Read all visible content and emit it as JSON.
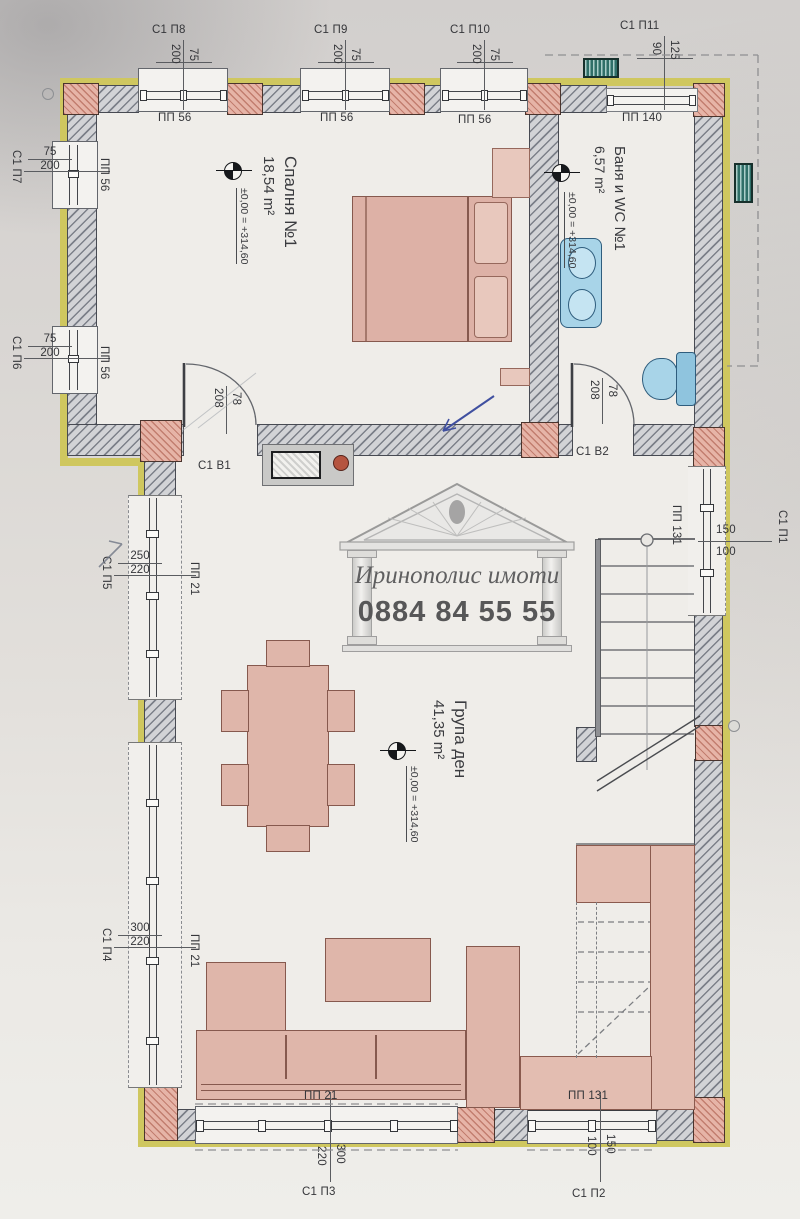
{
  "watermark": {
    "agency": "Иринополис имоти",
    "phone": "0884 84 55 55"
  },
  "rooms": {
    "bedroom": {
      "name": "Спалня №1",
      "area": "18,54 m²",
      "level": "±0,00 = +314,60"
    },
    "bath": {
      "name": "Баня и WC №1",
      "area": "6,57 m²",
      "level": "±0,00 = +314,60"
    },
    "living": {
      "name": "Група ден",
      "area": "41,35 m²",
      "level": "±0,00 = +314,60"
    }
  },
  "windows": {
    "p8": {
      "code": "С1 П8",
      "dim_a": "200",
      "dim_b": "75",
      "lintel": "ПП 56"
    },
    "p9": {
      "code": "С1 П9",
      "dim_a": "200",
      "dim_b": "75",
      "lintel": "ПП 56"
    },
    "p10": {
      "code": "С1 П10",
      "dim_a": "200",
      "dim_b": "75",
      "lintel": "ПП 56"
    },
    "p11": {
      "code": "С1 П11",
      "dim_a": "90",
      "dim_b": "125",
      "lintel": "ПП 140"
    },
    "p7": {
      "code": "С1 П7",
      "dim_a": "75",
      "dim_b": "200",
      "lintel": "ПП 56"
    },
    "p6": {
      "code": "С1 П6",
      "dim_a": "75",
      "dim_b": "200",
      "lintel": "ПП 56"
    },
    "p5": {
      "code": "С1 П5",
      "dim_a": "250",
      "dim_b": "220",
      "lintel": "ПП 21"
    },
    "p4": {
      "code": "С1 П4",
      "dim_a": "300",
      "dim_b": "220",
      "lintel": "ПП 21"
    },
    "p1": {
      "code": "С1 П1",
      "dim_a": "150",
      "dim_b": "100",
      "lintel": "ПП 131"
    },
    "p3": {
      "code": "С1 П3",
      "dim_a": "220",
      "dim_b": "300",
      "lintel": "ПП 21"
    },
    "p2": {
      "code": "С1 П2",
      "dim_a": "100",
      "dim_b": "150",
      "lintel": "ПП 131"
    }
  },
  "doors": {
    "b1": {
      "code": "С1 В1",
      "dim_a": "208",
      "dim_b": "78"
    },
    "b2": {
      "code": "С1 В2",
      "dim_a": "208",
      "dim_b": "78"
    }
  },
  "colors": {
    "insulation_yellow": "#cfc75f",
    "column_pink": "#e6b4a7",
    "furniture_pink": "#dfb6aa",
    "fixture_blue": "#a8d4e8",
    "vent_teal": "#2f6f68",
    "pen_blue": "#4050a0"
  }
}
